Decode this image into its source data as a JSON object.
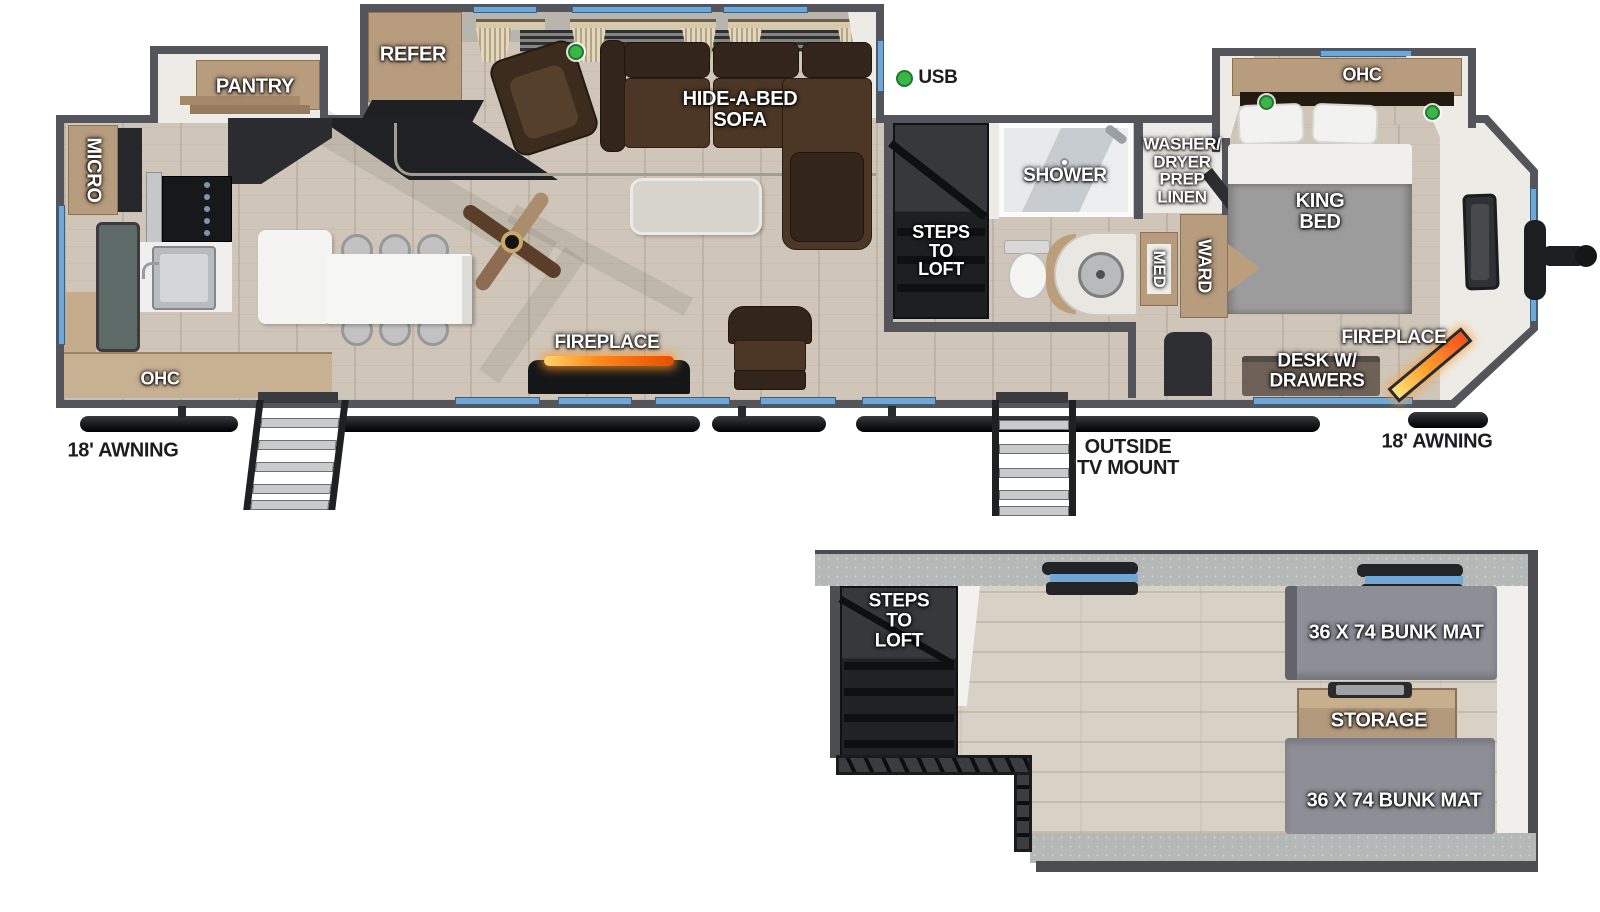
{
  "colors": {
    "wall": "#54555a",
    "floor_wood": "#cfc6b9",
    "window_blue": "#6fa8d6",
    "usb_dot_green": "#3cb549",
    "sofa_brown": "#4c3726",
    "bunk_mat_gray": "#8e8f97",
    "fireplace_glow_orange": "#ff8a1e",
    "interior_label_text": "#ffffff",
    "exterior_label_text": "#1d1d1f"
  },
  "main_floor": {
    "kitchen": {
      "micro": "MICRO",
      "pantry": "PANTRY",
      "refer": "REFER",
      "ohc": "OHC"
    },
    "living": {
      "hide_a_bed_sofa": "HIDE-A-BED\nSOFA",
      "usb": "USB",
      "fireplace": "FIREPLACE"
    },
    "bath": {
      "shower": "SHOWER",
      "steps_to_loft": "STEPS\nTO\nLOFT",
      "washer_dryer": "WASHER/\nDRYER\nPREP\nLINEN",
      "med": "MED",
      "ward": "WARD"
    },
    "bedroom": {
      "ohc": "OHC",
      "king_bed": "KING\nBED",
      "desk": "DESK W/\nDRAWERS",
      "fireplace": "FIREPLACE"
    },
    "exterior": {
      "awning_left": "18' AWNING",
      "outside_tv_mount": "OUTSIDE\nTV MOUNT",
      "awning_right": "18' AWNING"
    }
  },
  "loft": {
    "steps_to_loft": "STEPS\nTO\nLOFT",
    "bunk_mat_top": "36 X 74 BUNK MAT",
    "storage": "STORAGE",
    "bunk_mat_bottom": "36 X 74 BUNK MAT"
  }
}
